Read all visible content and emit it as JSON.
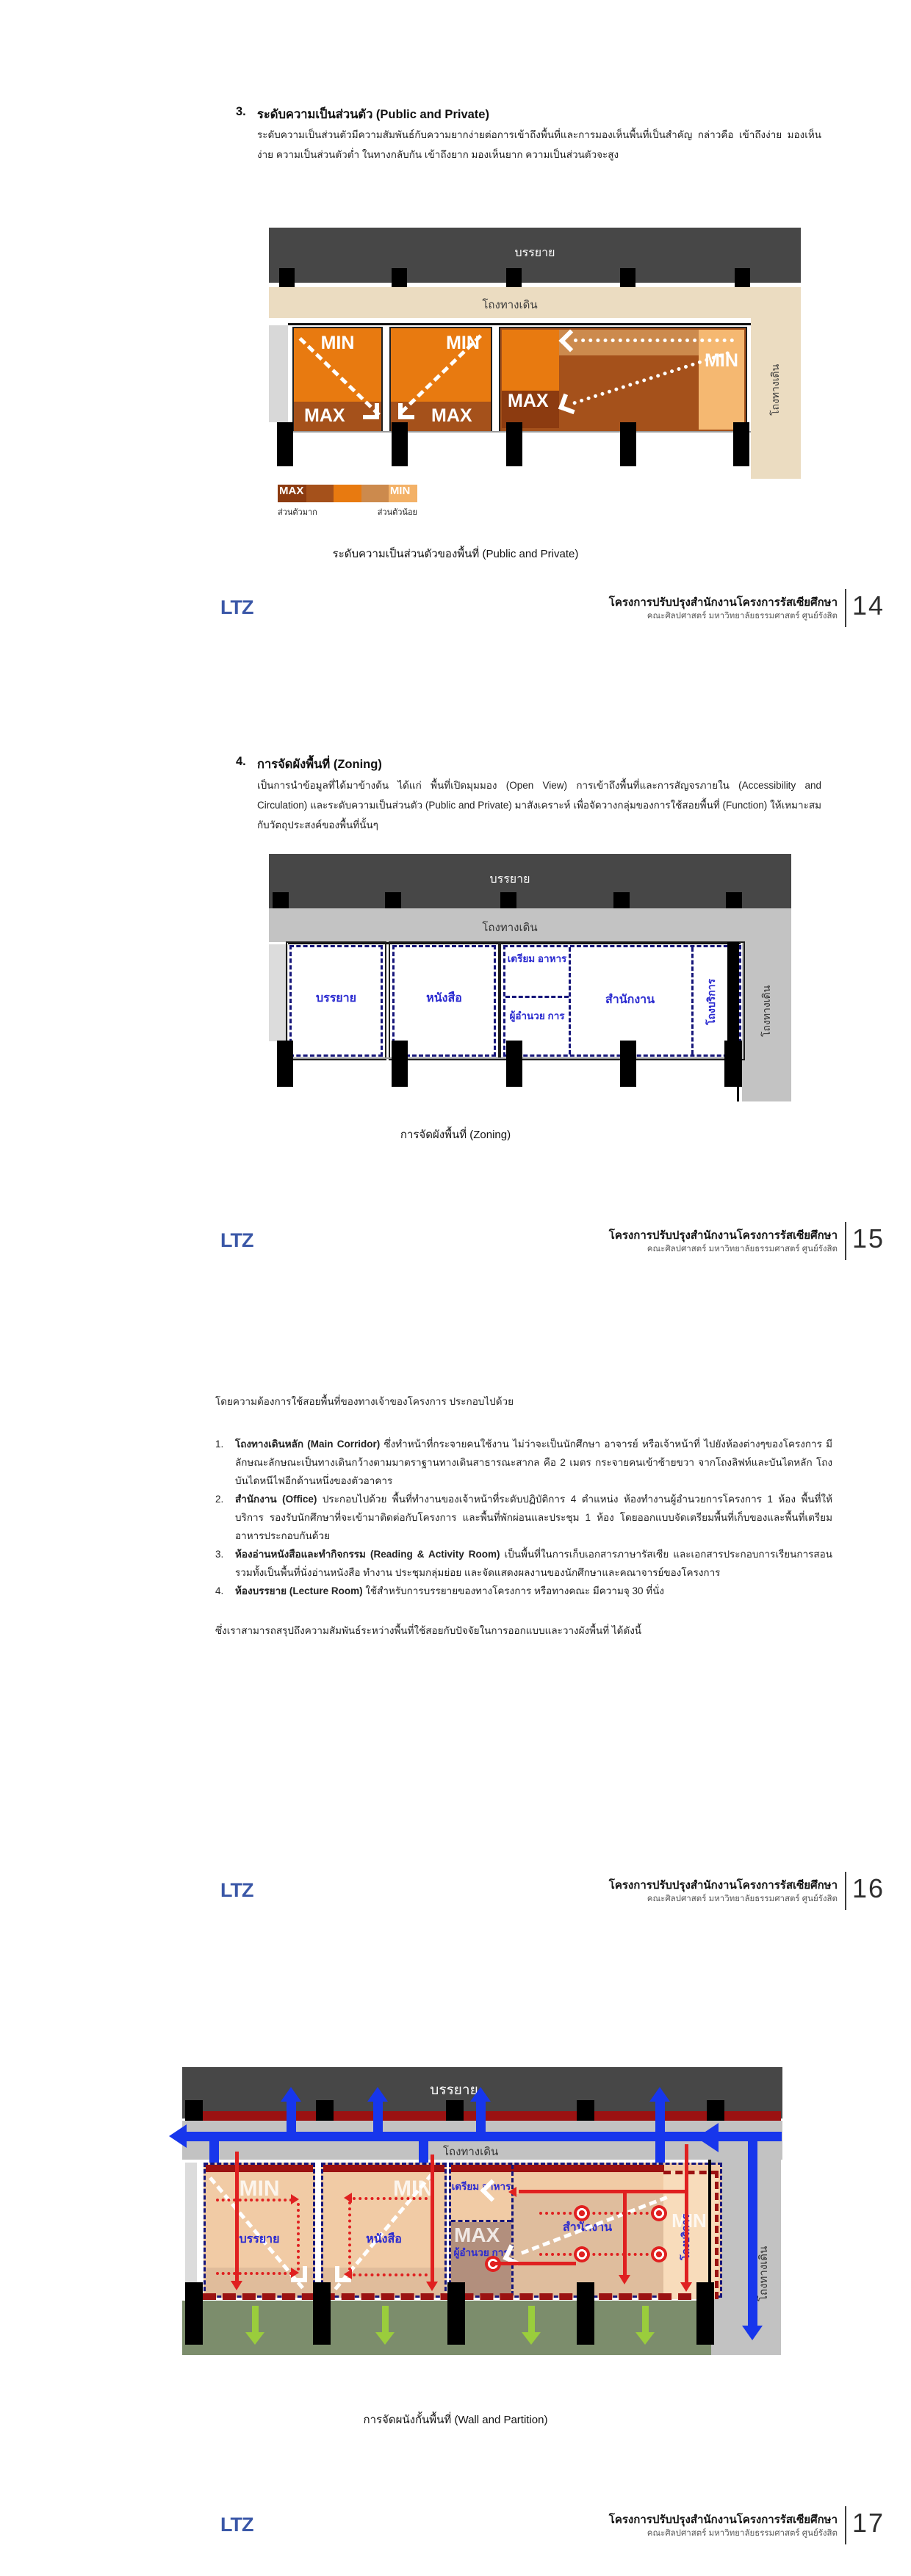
{
  "footer": {
    "logo": "LTZ",
    "project_title": "โครงการปรับปรุงสำนักงานโครงการรัสเซียศึกษา",
    "project_subtitle": "คณะศิลปศาสตร์ มหาวิทยาลัยธรรมศาสตร์ ศูนย์รังสิต",
    "pages": [
      "14",
      "15",
      "16",
      "17"
    ]
  },
  "section3": {
    "number": "3.",
    "title": "ระดับความเป็นส่วนตัว (Public and Private)",
    "body": "ระดับความเป็นส่วนตัวมีความสัมพันธ์กับความยากง่ายต่อการเข้าถึงพื้นที่และการมองเห็นพื้นที่เป็นสำคัญ กล่าวคือ เข้าถึงง่าย มองเห็นง่าย ความเป็นส่วนตัวต่ำ ในทางกลับกัน เข้าถึงยาก มองเห็นยาก ความเป็นส่วนตัวจะสูง",
    "caption": "ระดับความเป็นส่วนตัวของพื้นที่ (Public and Private)"
  },
  "section4": {
    "number": "4.",
    "title": "การจัดผังพื้นที่ (Zoning)",
    "body": "เป็นการนำข้อมูลที่ได้มาข้างต้น ได้แก่ พื้นที่เปิดมุมมอง (Open View) การเข้าถึงพื้นที่และการสัญจรภายใน (Accessibility and Circulation) และระดับความเป็นส่วนตัว (Public and Private) มาสังเคราะห์ เพื่อจัดวางกลุ่มของการใช้สอยพื้นที่ (Function) ให้เหมาะสมกับวัตถุประสงค์ของพื้นที่นั้นๆ",
    "caption": "การจัดผังพื้นที่ (Zoning)"
  },
  "requirements": {
    "intro": "โดยความต้องการใช้สอยพื้นที่ของทางเจ้าของโครงการ ประกอบไปด้วย",
    "items": [
      {
        "no": "1.",
        "title": "โถงทางเดินหลัก (Main Corridor)",
        "text": "ซึ่งทำหน้าที่กระจายคนใช้งาน ไม่ว่าจะเป็นนักศึกษา อาจารย์ หรือเจ้าหน้าที่ ไปยังห้องต่างๆของโครงการ มีลักษณะลักษณะเป็นทางเดินกว้างตามมาตราฐานทางเดินสาธารณะสากล คือ 2 เมตร กระจายคนเข้าซ้ายขวา จากโถงลิฟท์และบันไดหลัก โถงบันไดหนีไฟอีกด้านหนึ่งของตัวอาคาร"
      },
      {
        "no": "2.",
        "title": "สำนักงาน (Office)",
        "text": "ประกอบไปด้วย พื้นที่ทำงานของเจ้าหน้าที่ระดับปฏิบัติการ 4 ตำแหน่ง ห้องทำงานผู้อำนวยการโครงการ 1 ห้อง พื้นที่ให้บริการ รองรับนักศึกษาที่จะเข้ามาติดต่อกับโครงการ และพื้นที่พักผ่อนและประชุม 1 ห้อง โดยออกแบบจัดเตรียมพื้นที่เก็บของและพื้นที่เตรียมอาหารประกอบกันด้วย"
      },
      {
        "no": "3.",
        "title": "ห้องอ่านหนังสือและทำกิจกรรม (Reading & Activity Room)",
        "text": "เป็นพื้นที่ในการเก็บเอกสารภาษารัสเซีย และเอกสารประกอบการเรียนการสอน รวมทั้งเป็นพื้นที่นั่งอ่านหนังสือ ทำงาน ประชุมกลุ่มย่อย และจัดแสดงผลงานของนักศึกษาและคณาจารย์ของโครงการ"
      },
      {
        "no": "4.",
        "title": "ห้องบรรยาย (Lecture Room)",
        "text": "ใช้สำหรับการบรรยายของทางโครงการ หรือทางคณะ มีความจุ 30 ที่นั่ง"
      }
    ],
    "closing": "ซึ่งเราสามารถสรุปถึงความสัมพันธ์ระหว่างพื้นที่ใช้สอยกับปัจจัยในการออกแบบและวางผังพื้นที่ ได้ดังนี้"
  },
  "page17": {
    "caption": "การจัดผนังกั้นพื้นที่ (Wall and Partition)"
  },
  "labels": {
    "lecture_zone": "บรรยาย",
    "corridor": "โถงทางเดิน",
    "min": "MIN",
    "max": "MAX",
    "legend_private_high": "ส่วนตัวมาก",
    "legend_private_low": "ส่วนตัวน้อย",
    "room_lecture": "บรรยาย",
    "room_books": "หนังสือ",
    "room_food": "เตรียม อาหาร",
    "room_director": "ผู้อำนวย การ",
    "room_office": "สำนักงาน",
    "room_service": "โถงบริการ"
  },
  "colors": {
    "privacy_scale": [
      "#8C3B10",
      "#A5511B",
      "#E87A10",
      "#CC8A4D",
      "#F3B167"
    ],
    "accent_blue": "#1736EC",
    "accent_red": "#E02020",
    "dark_red": "#9B1212",
    "green_zone": "#7C8D6C",
    "green_arrow": "#9ACD3C"
  }
}
